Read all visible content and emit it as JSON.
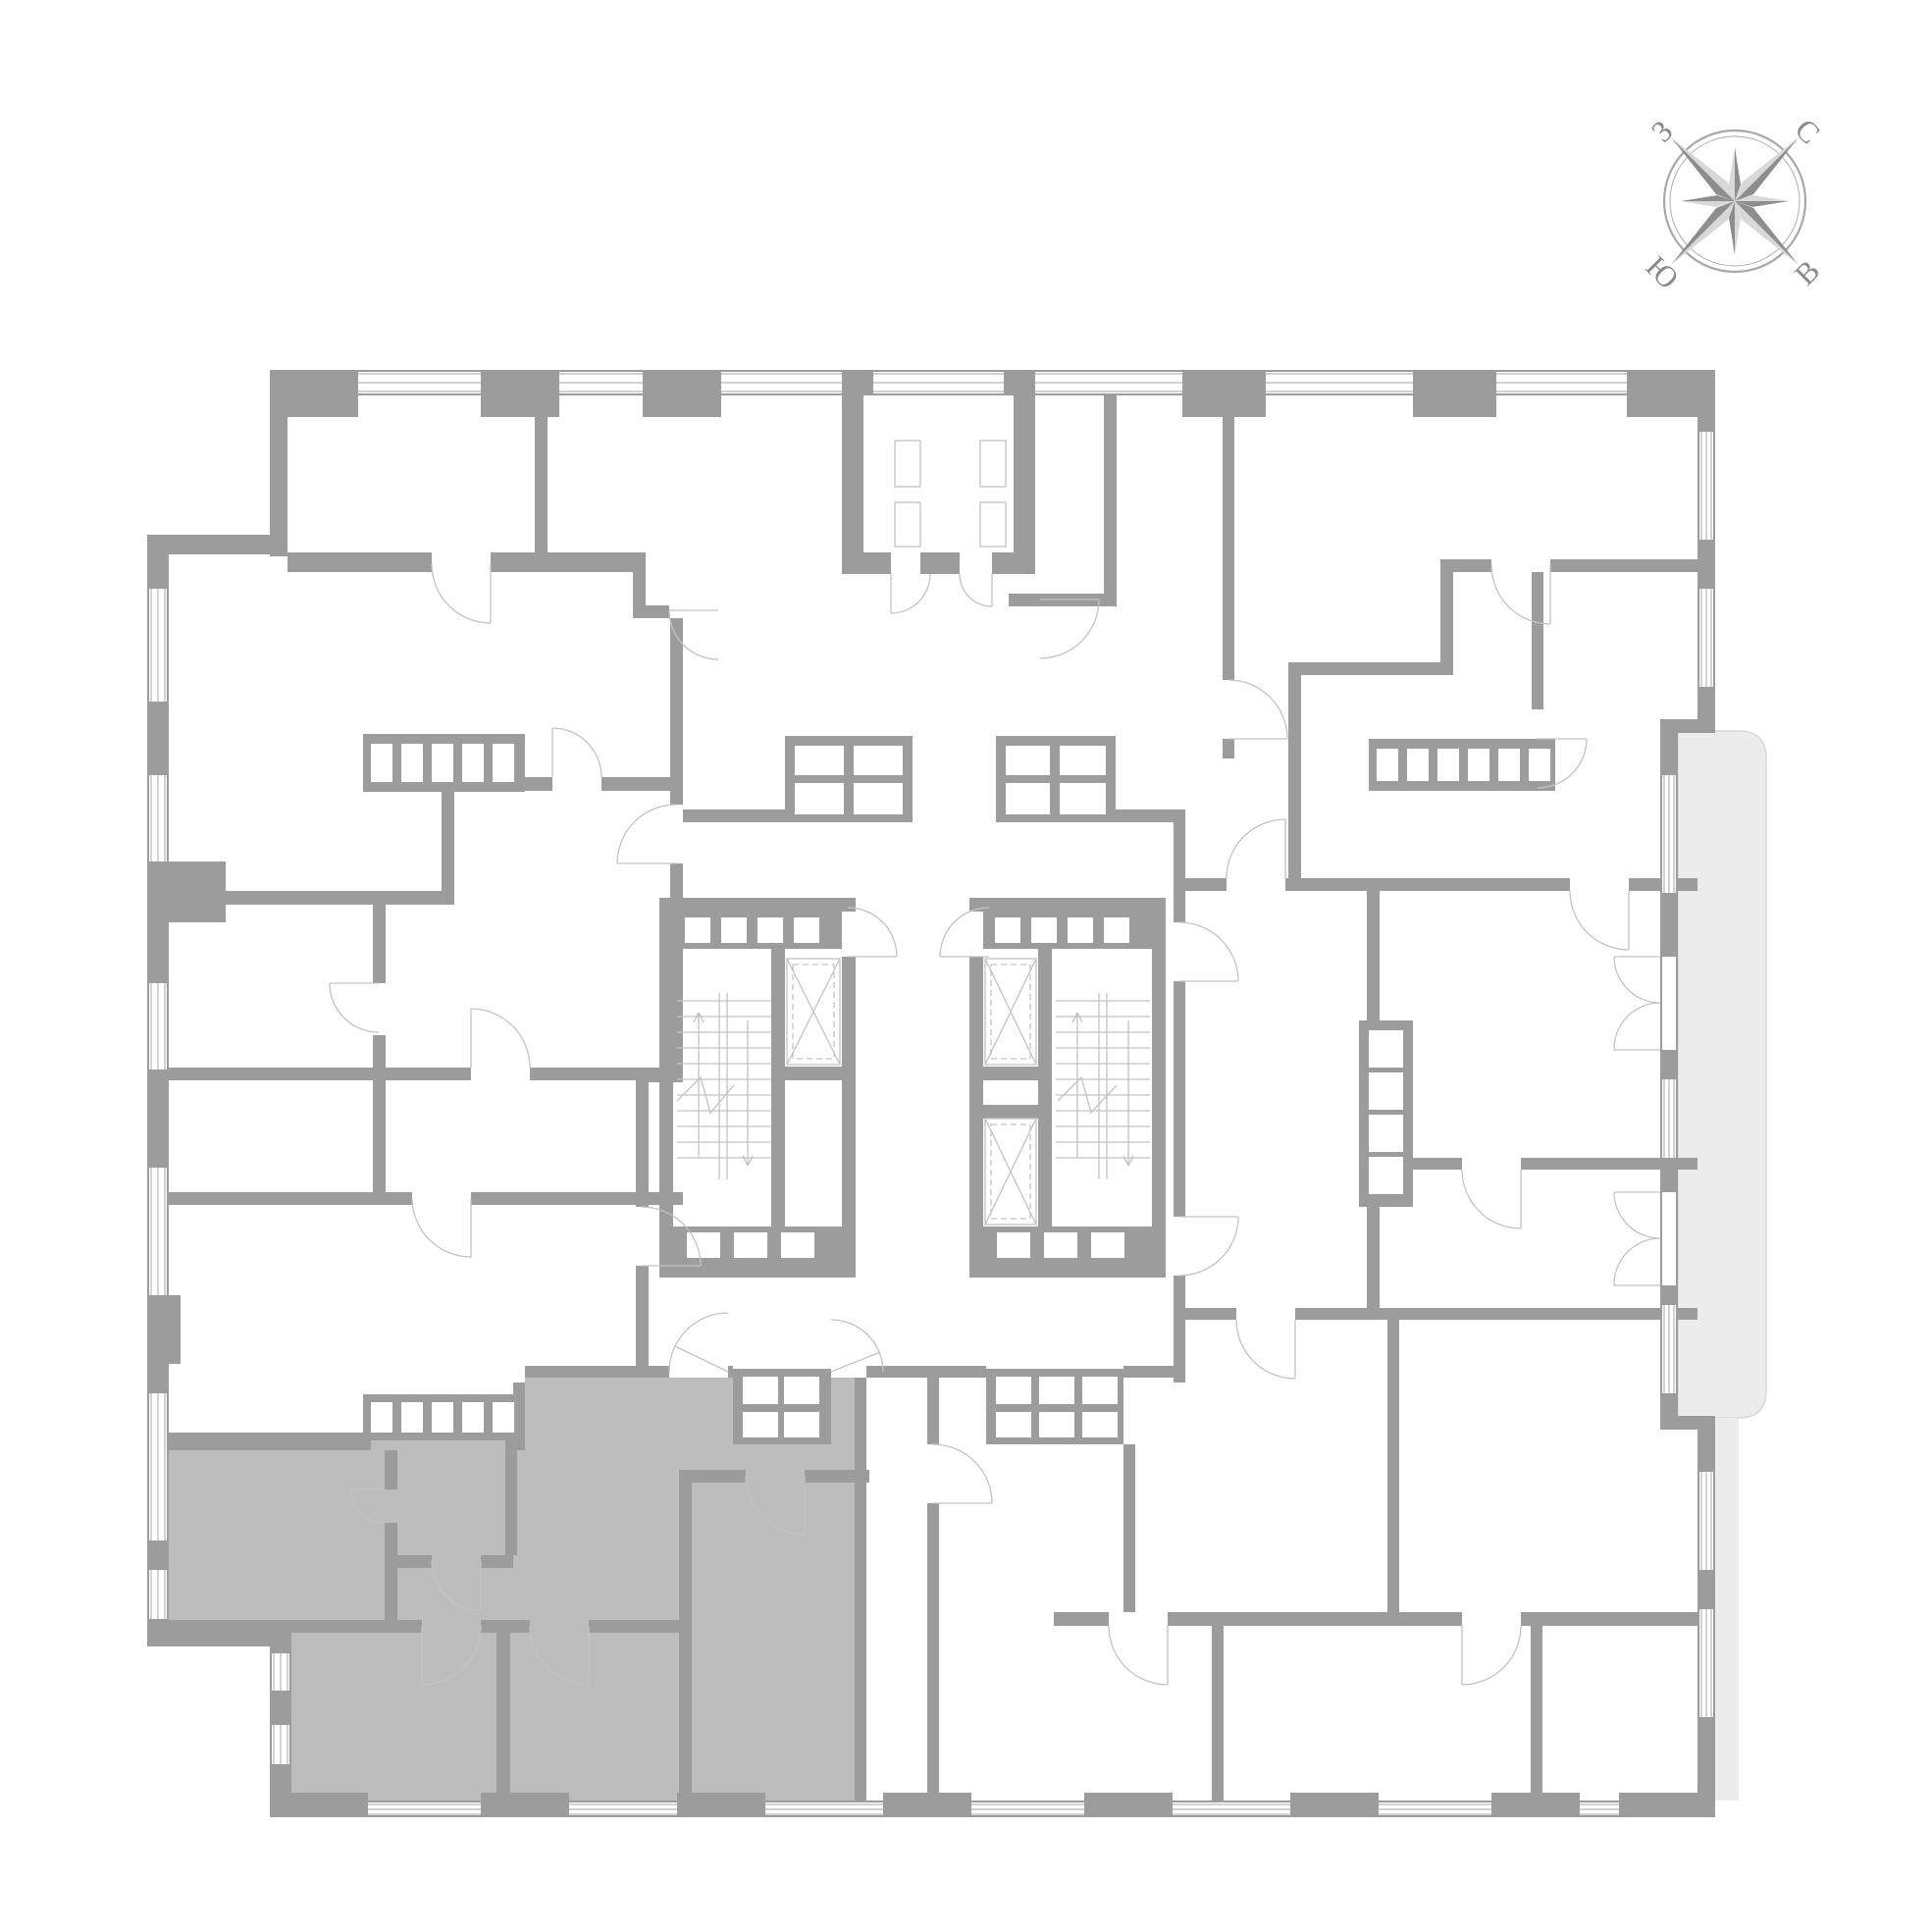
{
  "compass": {
    "north_label": "С",
    "east_label": "В",
    "south_label": "Ю",
    "west_label": "З"
  },
  "colors": {
    "background": "#ffffff",
    "wall": "#9c9c9c",
    "apartment_highlight": "#bdbdbd",
    "thin_line": "#c3c3c3",
    "leaf_line": "#b6b6b6",
    "white": "#ffffff",
    "balcony_fill": "#ececec",
    "balcony_stroke": "#d8d8d8",
    "compass_dark": "#8d8d8d",
    "compass_light": "#d8d8d8",
    "compass_ring": "#a8a8a8",
    "compass_letter": "#8a8a8a"
  }
}
